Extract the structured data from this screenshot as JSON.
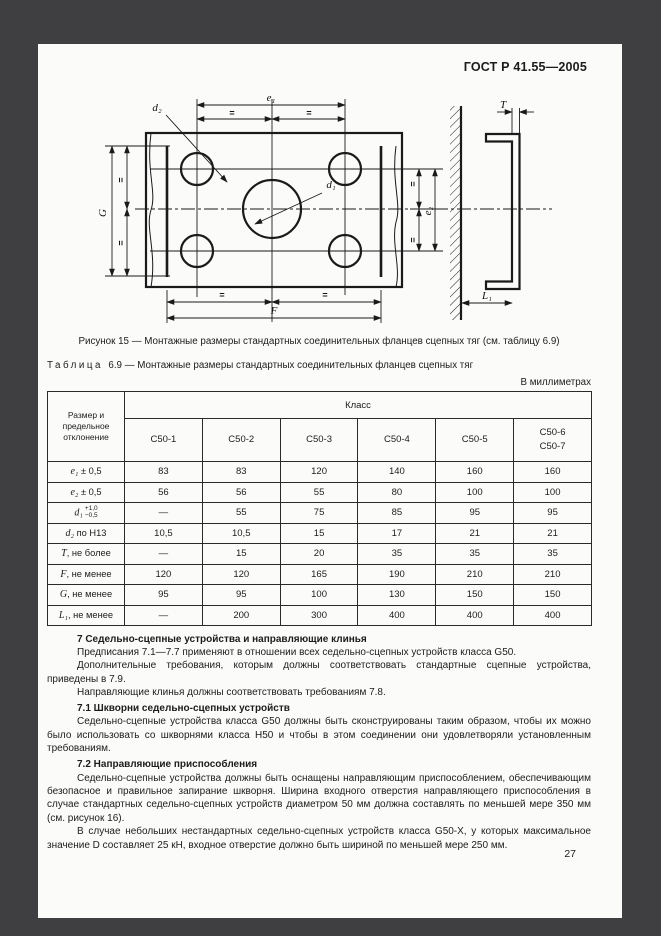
{
  "header": {
    "doc_number": "ГОСТ Р 41.55—2005"
  },
  "figure": {
    "caption": "Рисунок 15 — Монтажные размеры стандартных соединительных фланцев сцепных тяг (см. таблицу 6.9)",
    "labels": {
      "e1": "e₁",
      "e2": "e₂",
      "d1": "d₁",
      "d2": "d₂",
      "G": "G",
      "T": "T",
      "F": "F",
      "L1": "L₁",
      "eq": "="
    }
  },
  "table": {
    "title_label": "Таблица",
    "title_text": "6.9 — Монтажные размеры стандартных соединительных фланцев сцепных тяг",
    "units_note": "В миллиметрах",
    "corner_header": "Размер и предельное отклонение",
    "class_header": "Класс",
    "columns": [
      [
        "C50-1"
      ],
      [
        "C50-2"
      ],
      [
        "C50-3"
      ],
      [
        "C50-4"
      ],
      [
        "C50-5"
      ],
      [
        "C50-6",
        "C50-7"
      ]
    ],
    "rows": [
      {
        "var": "e₁",
        "rest": " ± 0,5",
        "values": [
          "83",
          "83",
          "120",
          "140",
          "160",
          "160"
        ]
      },
      {
        "var": "e₂",
        "rest": " ± 0,5",
        "values": [
          "56",
          "56",
          "55",
          "80",
          "100",
          "100"
        ]
      },
      {
        "var": "d₁",
        "sup": "+1,0",
        "sub": "−0,5",
        "values": [
          "—",
          "55",
          "75",
          "85",
          "95",
          "95"
        ]
      },
      {
        "var": "d₂",
        "rest": " по H13",
        "values": [
          "10,5",
          "10,5",
          "15",
          "17",
          "21",
          "21"
        ]
      },
      {
        "var": "T",
        "rest": ", не более",
        "values": [
          "—",
          "15",
          "20",
          "35",
          "35",
          "35"
        ]
      },
      {
        "var": "F",
        "rest": ", не менее",
        "values": [
          "120",
          "120",
          "165",
          "190",
          "210",
          "210"
        ]
      },
      {
        "var": "G",
        "rest": ", не менее",
        "values": [
          "95",
          "95",
          "100",
          "130",
          "150",
          "150"
        ]
      },
      {
        "var": "L₁",
        "rest": ", не менее",
        "values": [
          "—",
          "200",
          "300",
          "400",
          "400",
          "400"
        ]
      }
    ]
  },
  "sections": {
    "items": [
      {
        "text": "7 Седельно-сцепные устройства и направляющие клинья",
        "bold": true
      },
      {
        "text": "Предписания 7.1—7.7 применяют в отношении всех седельно-сцепных устройств класса G50.",
        "bold": false
      },
      {
        "text": "Дополнительные требования, которым должны соответствовать стандартные сцепные устройства, приведены в 7.9.",
        "bold": false
      },
      {
        "text": "Направляющие клинья должны соответствовать требованиям 7.8.",
        "bold": false
      },
      {
        "text": "7.1 Шкворни седельно-сцепных устройств",
        "bold": true
      },
      {
        "text": "Седельно-сцепные устройства класса G50 должны быть сконструированы таким образом, чтобы их можно было использовать со шкворнями класса H50 и чтобы в этом соединении они удовлетворяли установленным требованиям.",
        "bold": false
      },
      {
        "text": "7.2 Направляющие приспособления",
        "bold": true
      },
      {
        "text": "Седельно-сцепные устройства должны быть оснащены направляющим приспособлением, обеспечивающим безопасное и правильное запирание шкворня. Ширина входного отверстия направляющего приспособления в случае стандартных седельно-сцепных устройств диаметром 50 мм должна составлять по меньшей мере 350 мм (см. рисунок 16).",
        "bold": false
      },
      {
        "text": "В случае небольших нестандартных седельно-сцепных устройств класса G50-X, у которых максимальное значение D составляет 25 кН, входное отверстие должно быть шириной по меньшей мере 250 мм.",
        "bold": false
      }
    ]
  },
  "page": {
    "number": "27"
  }
}
